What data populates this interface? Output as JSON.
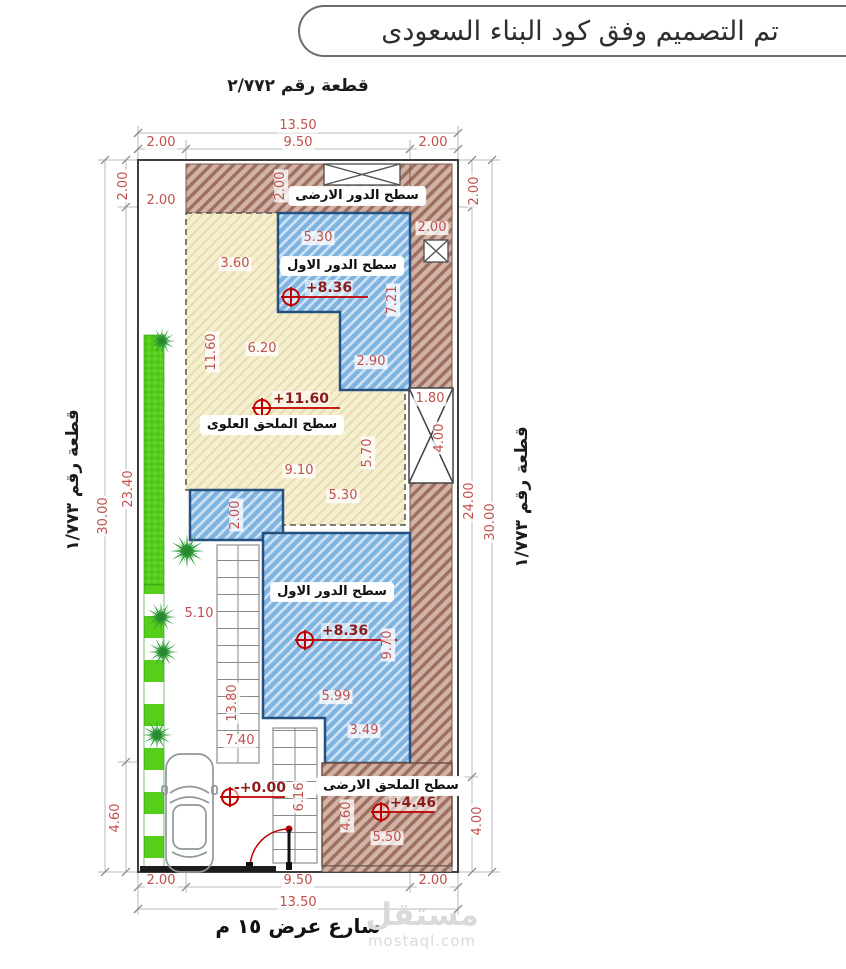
{
  "title": "تم التصميم وفق كود البناء السعودى",
  "plots": {
    "top": "قطعة رقم ٢/٧٧٢",
    "left": "قطعة رقم ١/٧٧٣",
    "right": "قطعة رقم ١/٧٧٣"
  },
  "street": "شارع عرض ١٥ م",
  "watermark": {
    "logo": "مستقل",
    "url": "mostaql.com"
  },
  "regions": {
    "ground_roof": "سطح الدور الارضى",
    "first_roof_top": "سطح الدور الاول",
    "upper_annex_roof": "سطح الملحق العلوى",
    "first_roof_mid": "سطح الدور الاول",
    "ground_annex_roof": "سطح الملحق الارضى"
  },
  "levels": [
    {
      "value": "+8.36"
    },
    {
      "value": "+11.60"
    },
    {
      "value": "+8.36"
    },
    {
      "value": "-+0.00"
    },
    {
      "value": "+4.46"
    }
  ],
  "colors": {
    "dim_red": "#c0504d",
    "level_red": "#8b1c1c",
    "marker_red": "#c00000",
    "blue_hatch": "#7fb3e0",
    "brown_hatch": "#d3b2a6",
    "beige_hatch": "#f6efcf",
    "green": "#55cf1c"
  },
  "dims": [
    {
      "t": "13.50",
      "x": 298,
      "y": 126,
      "r": 0
    },
    {
      "t": "2.00",
      "x": 161,
      "y": 143,
      "r": 0
    },
    {
      "t": "9.50",
      "x": 298,
      "y": 143,
      "r": 0
    },
    {
      "t": "2.00",
      "x": 433,
      "y": 143,
      "r": 0
    },
    {
      "t": "2.00",
      "x": 124,
      "y": 186,
      "r": -90
    },
    {
      "t": "2.00",
      "x": 161,
      "y": 201,
      "r": 0
    },
    {
      "t": "2.00",
      "x": 281,
      "y": 186,
      "r": -90
    },
    {
      "t": "2.00",
      "x": 432,
      "y": 228,
      "r": 0
    },
    {
      "t": "2.00",
      "x": 475,
      "y": 191,
      "r": -90
    },
    {
      "t": "3.60",
      "x": 235,
      "y": 264,
      "r": 0
    },
    {
      "t": "5.30",
      "x": 318,
      "y": 238,
      "r": 0
    },
    {
      "t": "7.21",
      "x": 393,
      "y": 300,
      "r": -90
    },
    {
      "t": "2.90",
      "x": 371,
      "y": 362,
      "r": 0
    },
    {
      "t": "11.60",
      "x": 212,
      "y": 352,
      "r": -90
    },
    {
      "t": "6.20",
      "x": 262,
      "y": 349,
      "r": 0
    },
    {
      "t": "1.80",
      "x": 430,
      "y": 399,
      "r": 0
    },
    {
      "t": "4.00",
      "x": 440,
      "y": 438,
      "r": -90
    },
    {
      "t": "9.10",
      "x": 299,
      "y": 471,
      "r": 0
    },
    {
      "t": "5.70",
      "x": 368,
      "y": 453,
      "r": -90
    },
    {
      "t": "5.30",
      "x": 343,
      "y": 496,
      "r": 0
    },
    {
      "t": "2.00",
      "x": 236,
      "y": 515,
      "r": -90
    },
    {
      "t": "30.00",
      "x": 104,
      "y": 516,
      "r": -90
    },
    {
      "t": "23.40",
      "x": 129,
      "y": 489,
      "r": -90
    },
    {
      "t": "24.00",
      "x": 470,
      "y": 501,
      "r": -90
    },
    {
      "t": "30.00",
      "x": 491,
      "y": 522,
      "r": -90
    },
    {
      "t": "5.10",
      "x": 199,
      "y": 614,
      "r": 0
    },
    {
      "t": "13.80",
      "x": 233,
      "y": 703,
      "r": -90
    },
    {
      "t": "7.40",
      "x": 240,
      "y": 741,
      "r": 0
    },
    {
      "t": "9.70",
      "x": 388,
      "y": 645,
      "r": -90
    },
    {
      "t": "5.99",
      "x": 336,
      "y": 697,
      "r": 0
    },
    {
      "t": "3.49",
      "x": 364,
      "y": 731,
      "r": 0
    },
    {
      "t": "6.16",
      "x": 300,
      "y": 797,
      "r": -90
    },
    {
      "t": "4.60",
      "x": 347,
      "y": 816,
      "r": -90
    },
    {
      "t": "5.50",
      "x": 387,
      "y": 838,
      "r": 0
    },
    {
      "t": "4.00",
      "x": 478,
      "y": 821,
      "r": -90
    },
    {
      "t": "4.60",
      "x": 116,
      "y": 818,
      "r": -90
    },
    {
      "t": "2.00",
      "x": 161,
      "y": 881,
      "r": 0
    },
    {
      "t": "9.50",
      "x": 298,
      "y": 881,
      "r": 0
    },
    {
      "t": "2.00",
      "x": 433,
      "y": 881,
      "r": 0
    },
    {
      "t": "13.50",
      "x": 298,
      "y": 903,
      "r": 0
    }
  ]
}
